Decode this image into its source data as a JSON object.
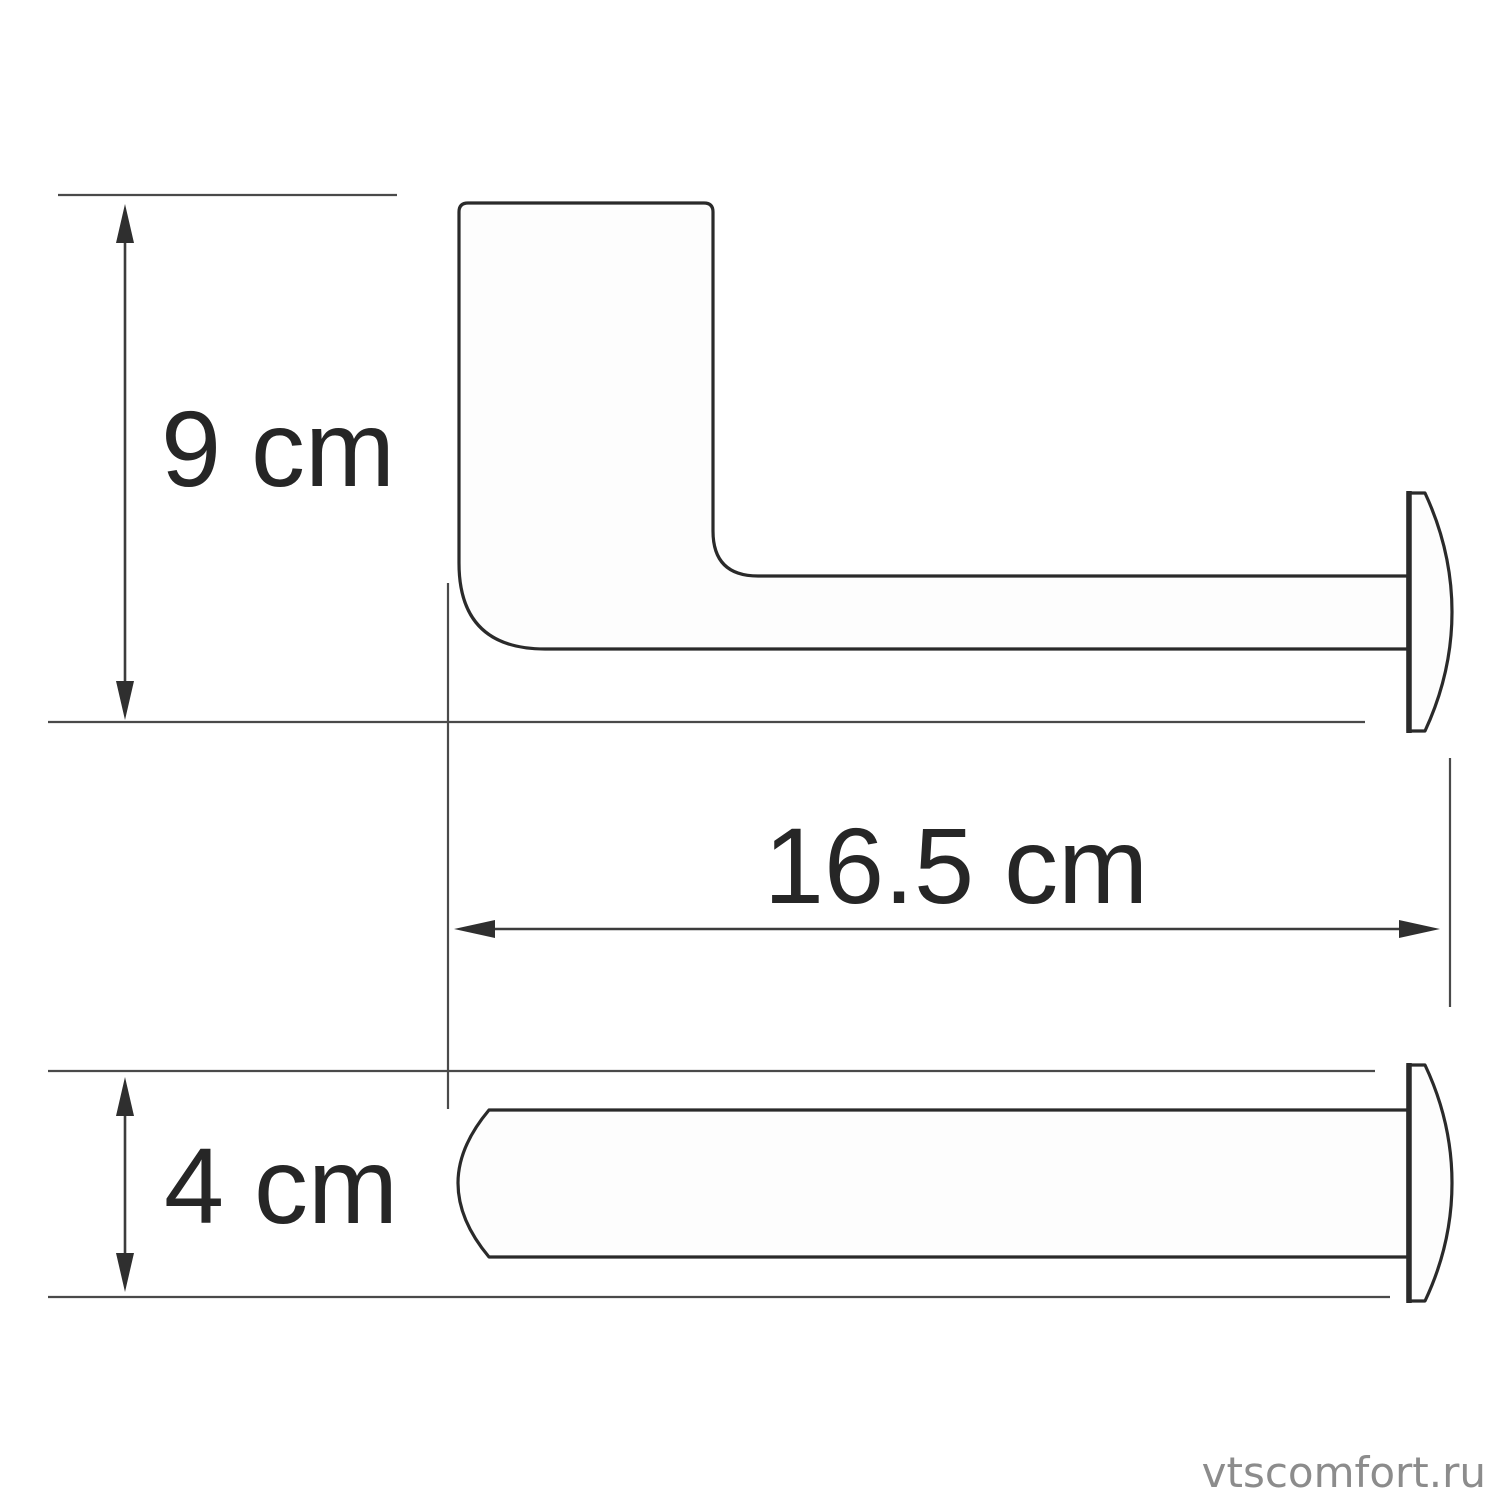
{
  "figure": {
    "type": "technical-dimension-drawing",
    "dimensions": [
      {
        "label": "9 cm",
        "value": 9,
        "unit": "cm",
        "axis": "vertical"
      },
      {
        "label": "16.5 cm",
        "value": 16.5,
        "unit": "cm",
        "axis": "horizontal"
      },
      {
        "label": "4 cm",
        "value": 4,
        "unit": "cm",
        "axis": "vertical"
      }
    ]
  },
  "watermark": {
    "text": "vtscomfort.ru"
  },
  "colors": {
    "background": "#ffffff",
    "outline": "#2a2a2a",
    "dimension_lines": "#3c3c3c",
    "label_text": "#262626",
    "watermark_text": "#8c8c8c"
  }
}
